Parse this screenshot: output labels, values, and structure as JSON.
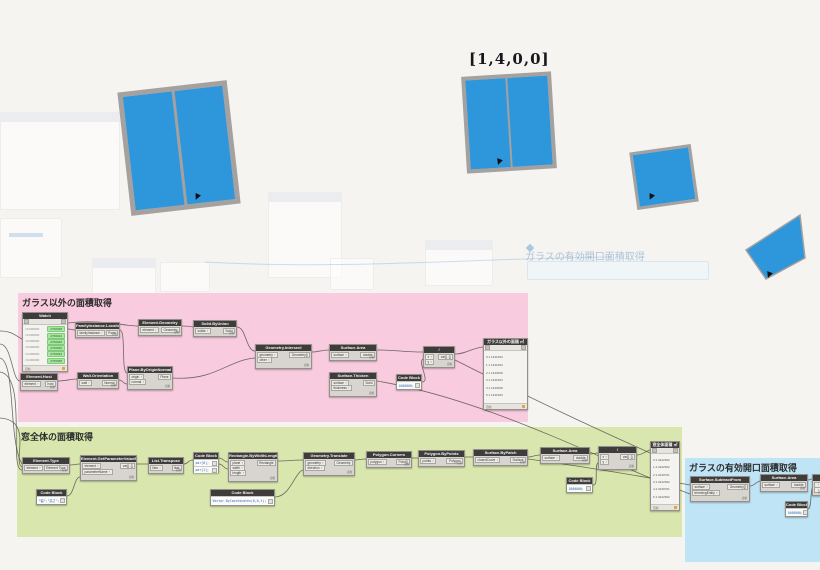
{
  "colors": {
    "canvas_bg": "#F5F4F1",
    "glass": "#2E96DB",
    "frame": "#A4A19E",
    "group_pink": "#F8CBDE",
    "group_green": "#D9E7AE",
    "group_blue": "#BEE4F6",
    "node_header": "#3E3D3B",
    "node_body": "#D8D5D0",
    "element_badge_green": "#A9E6A2",
    "wire": "#55544C"
  },
  "preview": {
    "index_label": "[1,4,0,0]",
    "ghost_group_title": "ガラスの有効開口面積取得"
  },
  "groups": {
    "pink": {
      "title": "ガラス以外の面積取得"
    },
    "green": {
      "title": "窓全体の面積取得"
    },
    "blue": {
      "title": "ガラスの有効開口面積取得"
    }
  },
  "ui": {
    "lacing_label": "自動"
  },
  "nodes": [
    {
      "id": "watch-elements",
      "title": "Watch",
      "kind": "watch-elems",
      "x": 22,
      "y": 312,
      "w": 46,
      "h": 60,
      "rows": [
        {
          "label": "=0.000000",
          "badge": "2766038"
        },
        {
          "label": "=0.000000",
          "badge": "2766042"
        },
        {
          "label": "=0.000000",
          "badge": "2766046"
        },
        {
          "label": "=0.000000",
          "badge": "2766050"
        },
        {
          "label": "=0.000000",
          "badge": "2766054"
        },
        {
          "label": "=0.000000",
          "badge": "2766058"
        }
      ]
    },
    {
      "id": "element-host",
      "title": "Element.Host",
      "kind": "std",
      "x": 20,
      "y": 373,
      "w": 38,
      "h": 18,
      "inputs": [
        "element"
      ],
      "outputs": [
        "host"
      ]
    },
    {
      "id": "familyinstance-location",
      "title": "FamilyInstance.Location",
      "kind": "std",
      "x": 75,
      "y": 322,
      "w": 45,
      "h": 16,
      "inputs": [
        "familyInstance"
      ],
      "outputs": [
        "Point"
      ]
    },
    {
      "id": "wall-orientation",
      "title": "Wall.Orientation",
      "kind": "std",
      "x": 77,
      "y": 372,
      "w": 42,
      "h": 17,
      "inputs": [
        "wall"
      ],
      "outputs": [
        "Normal"
      ]
    },
    {
      "id": "plane-byoriginnormal",
      "title": "Plane.ByOriginNormal",
      "kind": "std",
      "x": 127,
      "y": 366,
      "w": 46,
      "h": 24,
      "inputs": [
        "origin",
        "normal"
      ],
      "outputs": [
        "Plane"
      ]
    },
    {
      "id": "element-geometry",
      "title": "Element.Geometry",
      "kind": "std",
      "x": 138,
      "y": 319,
      "w": 44,
      "h": 17,
      "inputs": [
        "element"
      ],
      "outputs": [
        "Geometry"
      ]
    },
    {
      "id": "solid-byunion",
      "title": "Solid.ByUnion",
      "kind": "std",
      "x": 193,
      "y": 320,
      "w": 44,
      "h": 17,
      "inputs": [
        "solids"
      ],
      "outputs": [
        "Solid"
      ]
    },
    {
      "id": "geometry-intersect",
      "title": "Geometry.Intersect",
      "kind": "std",
      "x": 255,
      "y": 344,
      "w": 57,
      "h": 25,
      "inputs": [
        "geometry",
        "other"
      ],
      "outputs": [
        "Geometry[]"
      ]
    },
    {
      "id": "surface-area-1",
      "title": "Surface.Area",
      "kind": "std",
      "x": 329,
      "y": 344,
      "w": 48,
      "h": 17,
      "inputs": [
        "surface"
      ],
      "outputs": [
        "double"
      ]
    },
    {
      "id": "surface-thicken",
      "title": "Surface.Thicken",
      "kind": "std",
      "x": 329,
      "y": 372,
      "w": 48,
      "h": 25,
      "inputs": [
        "surface",
        "thickness"
      ],
      "outputs": [
        "Solid"
      ]
    },
    {
      "id": "code-block-pink",
      "title": "Code Block",
      "kind": "code",
      "x": 396,
      "y": 374,
      "w": 26,
      "h": 16,
      "rows": [
        "1000000;"
      ]
    },
    {
      "id": "divide-1",
      "title": "/",
      "kind": "std",
      "x": 423,
      "y": 346,
      "w": 32,
      "h": 22,
      "inputs": [
        "x",
        "y"
      ],
      "outputs": [
        "var[]..[]"
      ]
    },
    {
      "id": "watch-pink",
      "title": "ガラス以外の面積 ㎡",
      "kind": "watch-list",
      "x": 483,
      "y": 338,
      "w": 45,
      "h": 72,
      "rows": [
        "0 1.1331963",
        "1 1.1331963",
        "2 1.1340258",
        "3 1.1331963",
        "4 1.1340258",
        "5 1.1331963"
      ]
    },
    {
      "id": "element-type",
      "title": "Element.Type",
      "kind": "std",
      "x": 22,
      "y": 457,
      "w": 48,
      "h": 17,
      "inputs": [
        "element"
      ],
      "outputs": [
        "Element Type"
      ]
    },
    {
      "id": "element-getparametervaluebyname",
      "title": "Element.GetParameterValueByName",
      "kind": "std",
      "x": 80,
      "y": 455,
      "w": 57,
      "h": 26,
      "inputs": [
        "element",
        "parameterName"
      ],
      "outputs": [
        "var[]..[]"
      ]
    },
    {
      "id": "code-block-params",
      "title": "Code Block",
      "kind": "code",
      "x": 36,
      "y": 489,
      "w": 31,
      "h": 16,
      "rows": [
        "\"幅\";\"高さ\";"
      ]
    },
    {
      "id": "list-transpose",
      "title": "List.Transpose",
      "kind": "std",
      "x": 148,
      "y": 457,
      "w": 36,
      "h": 17,
      "inputs": [
        "lists"
      ],
      "outputs": [
        "lists"
      ]
    },
    {
      "id": "code-block-par",
      "title": "Code Block",
      "kind": "code",
      "x": 193,
      "y": 452,
      "w": 26,
      "h": 21,
      "rows": [
        "par[0];",
        "par[1];"
      ]
    },
    {
      "id": "rectangle-bywidthlength",
      "title": "Rectangle.ByWidthLength",
      "kind": "std",
      "x": 228,
      "y": 452,
      "w": 50,
      "h": 30,
      "inputs": [
        "plane",
        "width",
        "length"
      ],
      "outputs": [
        "Rectangle"
      ]
    },
    {
      "id": "code-block-vector",
      "title": "Code Block",
      "kind": "code",
      "x": 210,
      "y": 489,
      "w": 65,
      "h": 17,
      "rows": [
        "Vector.ByCoordinates(0,0,t);"
      ]
    },
    {
      "id": "geometry-translate",
      "title": "Geometry.Translate",
      "kind": "std",
      "x": 303,
      "y": 452,
      "w": 52,
      "h": 24,
      "inputs": [
        "geometry",
        "direction"
      ],
      "outputs": [
        "Geometry"
      ]
    },
    {
      "id": "polygon-corners",
      "title": "Polygon.Corners",
      "kind": "std",
      "x": 366,
      "y": 451,
      "w": 46,
      "h": 17,
      "inputs": [
        "polygon"
      ],
      "outputs": [
        "Point[]"
      ]
    },
    {
      "id": "polygon-bypoints",
      "title": "Polygon.ByPoints",
      "kind": "std",
      "x": 418,
      "y": 450,
      "w": 47,
      "h": 17,
      "inputs": [
        "points"
      ],
      "outputs": [
        "Polygon"
      ]
    },
    {
      "id": "surface-bypatch",
      "title": "Surface.ByPatch",
      "kind": "std",
      "x": 473,
      "y": 449,
      "w": 55,
      "h": 17,
      "inputs": [
        "closedCurve"
      ],
      "outputs": [
        "Surface"
      ]
    },
    {
      "id": "surface-area-2",
      "title": "Surface.Area",
      "kind": "std",
      "x": 540,
      "y": 447,
      "w": 50,
      "h": 17,
      "inputs": [
        "surface"
      ],
      "outputs": [
        "double"
      ]
    },
    {
      "id": "code-block-green",
      "title": "Code Block",
      "kind": "code",
      "x": 566,
      "y": 477,
      "w": 27,
      "h": 16,
      "rows": [
        "1000000;"
      ]
    },
    {
      "id": "divide-2",
      "title": "/",
      "kind": "std",
      "x": 598,
      "y": 446,
      "w": 39,
      "h": 24,
      "inputs": [
        "x",
        "y"
      ],
      "outputs": [
        "var[]..[]"
      ]
    },
    {
      "id": "watch-green",
      "title": "窓全体面積 ㎡",
      "kind": "watch-list",
      "x": 650,
      "y": 441,
      "w": 30,
      "h": 70,
      "rows": [
        "0 4.3222392",
        "1 4.3222392",
        "2 4.3230761",
        "3 4.3222392",
        "4 4.3230761",
        "5 4.3222392"
      ]
    },
    {
      "id": "surface-subtractfrom",
      "title": "Surface.SubtractFrom",
      "kind": "std",
      "x": 690,
      "y": 476,
      "w": 60,
      "h": 26,
      "inputs": [
        "surface",
        "trimmingEntity"
      ],
      "outputs": [
        "Geometry[]"
      ]
    },
    {
      "id": "surface-area-3",
      "title": "Surface.Area",
      "kind": "std",
      "x": 760,
      "y": 474,
      "w": 48,
      "h": 18,
      "inputs": [
        "surface"
      ],
      "outputs": [
        "double"
      ]
    },
    {
      "id": "code-block-blue",
      "title": "Code Block",
      "kind": "code",
      "x": 785,
      "y": 501,
      "w": 23,
      "h": 16,
      "rows": [
        "1000000;"
      ]
    },
    {
      "id": "cut-node",
      "title": "",
      "kind": "std",
      "x": 812,
      "y": 474,
      "w": 14,
      "h": 22,
      "inputs": [
        "",
        ""
      ],
      "outputs": []
    }
  ]
}
